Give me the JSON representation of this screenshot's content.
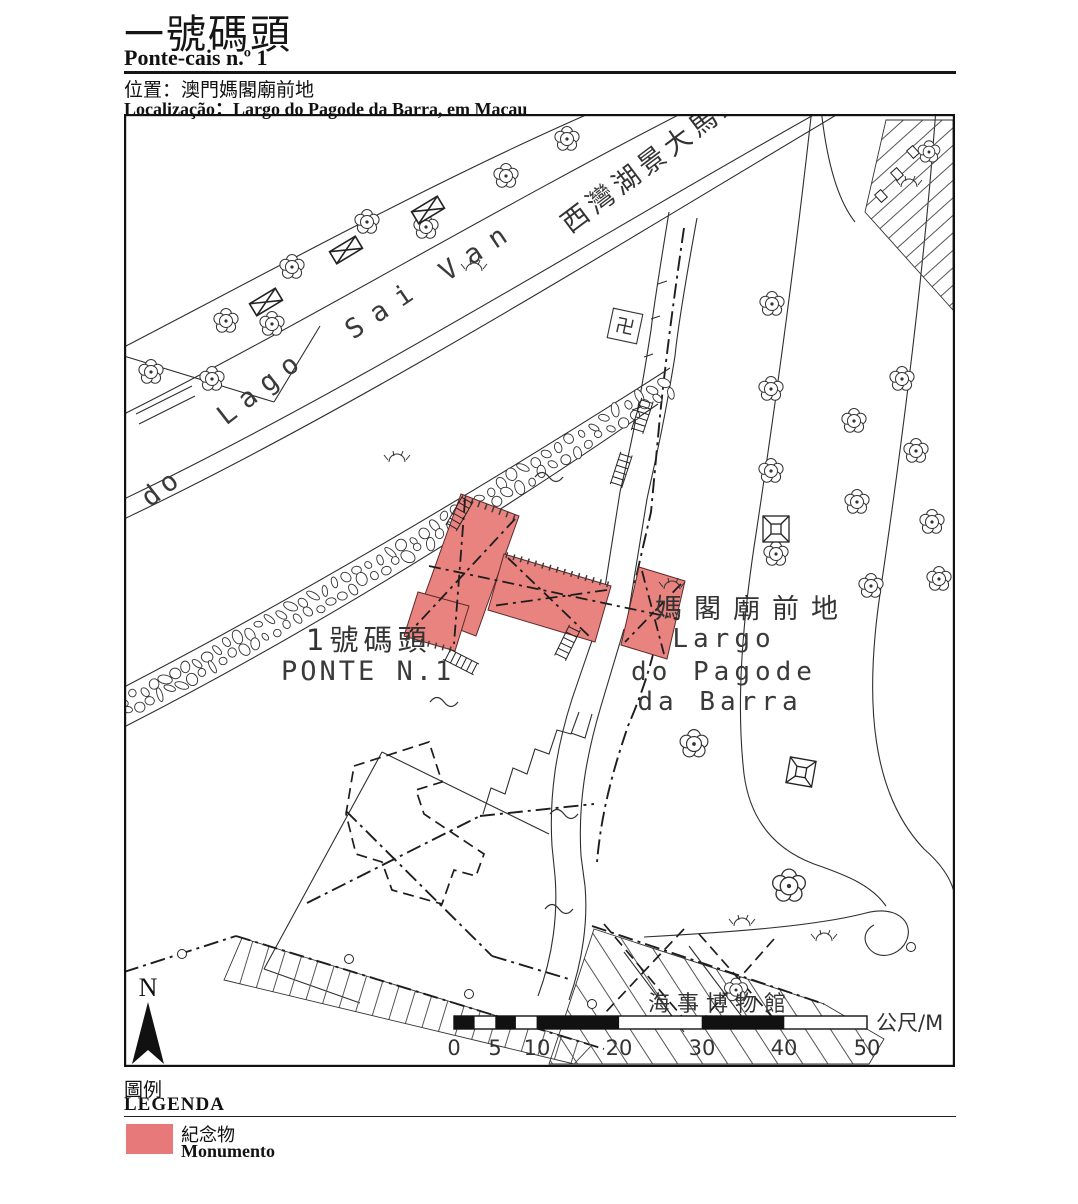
{
  "header": {
    "title_zh": "一號碼頭",
    "title_pt": "Ponte-cais n.º 1",
    "location_zh": "位置：澳門媽閣廟前地",
    "location_pt": "Localização：Largo do Pagode da Barra, em Macau"
  },
  "map": {
    "road_name": "西灣湖景大馬路",
    "lake_words": [
      "do",
      "Lago",
      "Sai",
      "Van"
    ],
    "temple_symbol": "卍",
    "pier_zh": "1號碼頭",
    "pier_pt": "PONTE N.1",
    "square_zh": "媽閣廟前地",
    "square_pt1": "Largo",
    "square_pt2": "do Pagode",
    "square_pt3": "da Barra",
    "museum_zh": "海事博物館",
    "north": "N",
    "scale": {
      "ticks": [
        "0",
        "5",
        "10",
        "20",
        "30",
        "40",
        "50"
      ],
      "unit": "公尺/M"
    }
  },
  "legend": {
    "title_zh": "圖例",
    "title_pt": "LEGENDA",
    "monument_zh": "紀念物",
    "monument_pt": "Monumento",
    "monument_color": "#E8797B"
  }
}
